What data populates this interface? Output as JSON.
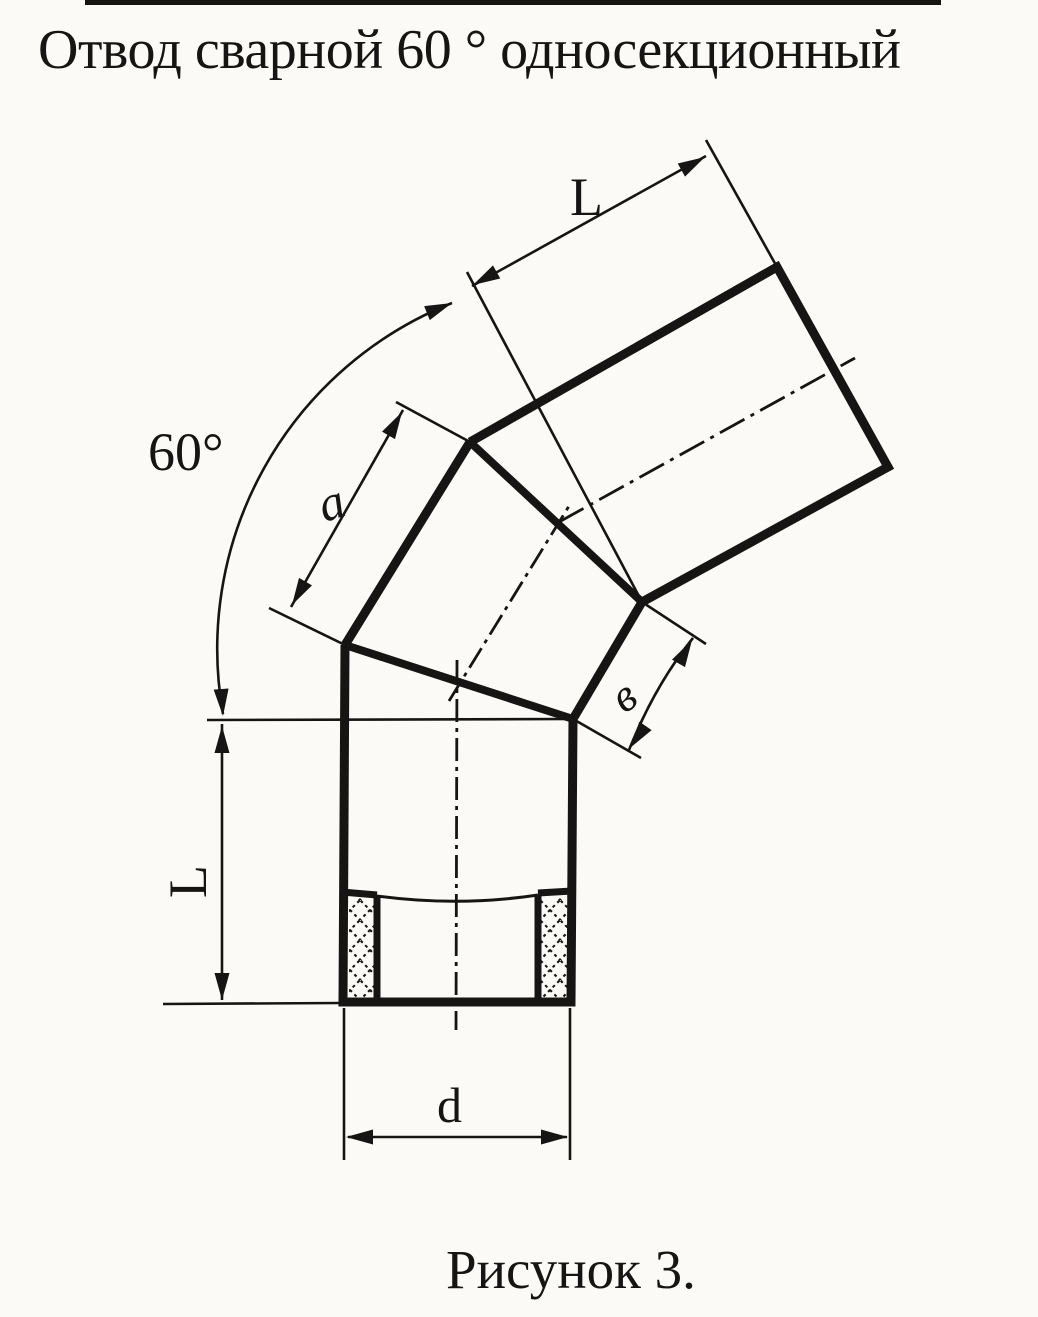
{
  "title": "Отвод сварной 60 ° односекционный",
  "caption": "Рисунок 3.",
  "dimensions": {
    "top_length": "L",
    "bend_angle": "60°",
    "outer_section": "a",
    "inner_section": "в",
    "left_length": "L",
    "diameter": "d"
  },
  "colors": {
    "ink": "#171514",
    "paper": "#fbfaf7"
  }
}
